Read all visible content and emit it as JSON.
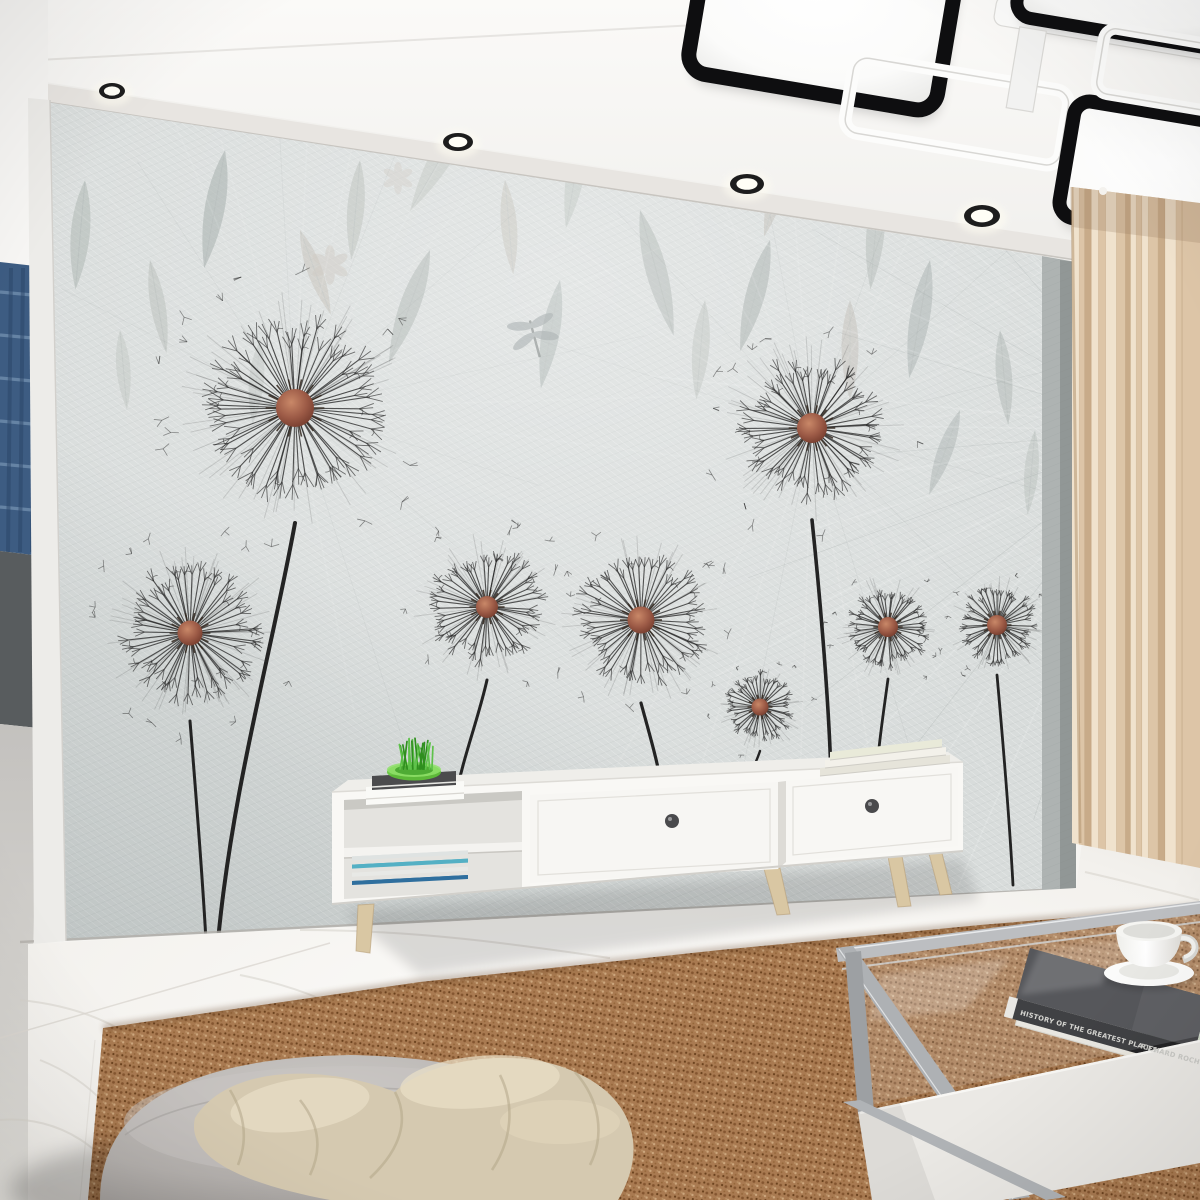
{
  "meta": {
    "description": "Living room interior photo: dandelion mural wallpaper, modern black and white ceiling lamp, white TV console, beige curtain, marble floor, brown sisal rug, gray pouf with beige blanket, glass coffee table with book and teacup",
    "width": 1200,
    "height": 1200
  },
  "palette": {
    "ceiling": "#f7f6f3",
    "molding": "#e8e5e1",
    "wall_base": "#d8dcdb",
    "wall_shade": "#c2c7c7",
    "side_wall": "#aeb3b2",
    "stem": "#232323",
    "spoke": "#2a2a2a",
    "dandelion_center": "#a65c48",
    "dandelion_center_dark": "#6f3a2c",
    "leaf_gray": "#a7aeab",
    "leaf_warm": "#b5ada3",
    "leaf_cool": "#9aa8a9",
    "curtain_light": "#f0e2cd",
    "curtain_mid": "#ddc5a7",
    "curtain_dark": "#c8ab89",
    "marble": "#f8f6f3",
    "marble_vein": "#d5d1ca",
    "rug_base": "#b28257",
    "rug_dark": "#7d5130",
    "rug_light": "#dbb68c",
    "furniture_white": "#f9f8f5",
    "wood_leg": "#d9c7a3",
    "pouf": "#bab6b3",
    "blanket": "#d5c9b0",
    "blanket_fold": "#b3a689",
    "metal": "#b5b7ba",
    "book_cover": "#3d3d40",
    "book_spine": "#232325",
    "spine_text_color": "#d6d6d2",
    "plant_green": "#4db32a",
    "bowl_green": "#5fc437",
    "blue_curtain": "#3d5c82"
  },
  "ceiling": {
    "spotlights": [
      {
        "x": 112,
        "y": 91,
        "rx": 13,
        "ry": 8
      },
      {
        "x": 458,
        "y": 142,
        "rx": 15,
        "ry": 9
      },
      {
        "x": 747,
        "y": 184,
        "rx": 17,
        "ry": 10
      },
      {
        "x": 982,
        "y": 216,
        "rx": 18,
        "ry": 11
      }
    ],
    "molding_top": [
      [
        40,
        82
      ],
      [
        1076,
        240
      ]
    ],
    "molding_bottom": [
      [
        46,
        102
      ],
      [
        1076,
        260
      ]
    ],
    "tray_line": [
      [
        0,
        62
      ],
      [
        715,
        24
      ]
    ]
  },
  "chandelier": {
    "pivot": [
      950,
      80
    ],
    "angle": 9.5,
    "elements": [
      {
        "type": "lit-panel",
        "x": 688,
        "y": -50,
        "w": 252,
        "h": 165,
        "rx": 20,
        "stroke": 15
      },
      {
        "type": "white-frame",
        "x": 853,
        "y": 72,
        "w": 218,
        "h": 76,
        "rx": 14,
        "stroke": 13
      },
      {
        "type": "white-bar",
        "x": 983,
        "y": -12,
        "w": 235,
        "h": 30,
        "rx": 9
      },
      {
        "type": "lit-panel",
        "x": 1003,
        "y": -102,
        "w": 232,
        "h": 108,
        "rx": 16,
        "stroke": 13
      },
      {
        "type": "connector",
        "x": 1010,
        "y": 16,
        "w": 27,
        "h": 82
      },
      {
        "type": "lit-panel",
        "x": 1078,
        "y": 78,
        "w": 225,
        "h": 118,
        "rx": 16,
        "stroke": 14
      },
      {
        "type": "white-frame",
        "x": 1095,
        "y": 2,
        "w": 235,
        "h": 66,
        "rx": 12,
        "stroke": 12
      }
    ]
  },
  "wallpaper": {
    "dandelions": [
      {
        "cx": 295,
        "cy": 408,
        "r": 115,
        "cr": 19,
        "sw": 4.0,
        "stem": "M295,523 C272,650 232,790 218,941"
      },
      {
        "cx": 190,
        "cy": 633,
        "r": 88,
        "cr": 12.5,
        "sw": 3.0,
        "stem": "M190,721 C196,795 202,868 206,941"
      },
      {
        "cx": 487,
        "cy": 607,
        "r": 73,
        "cr": 11,
        "sw": 3.0,
        "stem": "M487,680 C478,720 463,757 455,800"
      },
      {
        "cx": 641,
        "cy": 620,
        "r": 83,
        "cr": 13.5,
        "sw": 3.2,
        "stem": "M641,703 C650,736 657,760 661,783"
      },
      {
        "cx": 812,
        "cy": 428,
        "r": 92,
        "cr": 15,
        "sw": 3.6,
        "stem": "M812,520 C821,606 829,706 831,776"
      },
      {
        "cx": 760,
        "cy": 707,
        "r": 44,
        "cr": 8.5,
        "sw": 2.4,
        "stem": "M760,751 C756,763 751,772 748,781"
      },
      {
        "cx": 888,
        "cy": 627,
        "r": 52,
        "cr": 10,
        "sw": 2.8,
        "stem": "M888,679 C884,709 879,741 877,769"
      },
      {
        "cx": 997,
        "cy": 625,
        "r": 50,
        "cr": 10,
        "sw": 2.8,
        "stem": "M997,675 C1003,742 1009,812 1013,885"
      }
    ],
    "bursts": [
      {
        "cx": 295,
        "cy": 408,
        "n": 26,
        "len": 420,
        "a0": -150,
        "a1": 80,
        "op": 0.09
      },
      {
        "cx": 812,
        "cy": 428,
        "n": 30,
        "len": 470,
        "a0": -160,
        "a1": 120,
        "op": 0.1
      },
      {
        "cx": 1160,
        "cy": 430,
        "n": 26,
        "len": 540,
        "a0": 110,
        "a1": 250,
        "op": 0.14
      }
    ],
    "leaves": [
      {
        "x": 85,
        "y": 180,
        "rot": 95,
        "l": 110,
        "w": 38,
        "c": "#a9b2ae",
        "o": 0.55
      },
      {
        "x": 150,
        "y": 260,
        "rot": 80,
        "l": 95,
        "w": 30,
        "c": "#b2b8b2",
        "o": 0.5
      },
      {
        "x": 225,
        "y": 150,
        "rot": 100,
        "l": 120,
        "w": 40,
        "c": "#9fa8a6",
        "o": 0.6
      },
      {
        "x": 300,
        "y": 230,
        "rot": 70,
        "l": 90,
        "w": 30,
        "c": "#b7b0a6",
        "o": 0.45
      },
      {
        "x": 360,
        "y": 160,
        "rot": 95,
        "l": 100,
        "w": 34,
        "c": "#adb3ae",
        "o": 0.5
      },
      {
        "x": 430,
        "y": 250,
        "rot": 110,
        "l": 120,
        "w": 40,
        "c": "#a3aba8",
        "o": 0.55
      },
      {
        "x": 505,
        "y": 180,
        "rot": 85,
        "l": 95,
        "w": 32,
        "c": "#b5aea4",
        "o": 0.4
      },
      {
        "x": 560,
        "y": 280,
        "rot": 100,
        "l": 110,
        "w": 36,
        "c": "#9aa5a2",
        "o": 0.5
      },
      {
        "x": 640,
        "y": 210,
        "rot": 75,
        "l": 130,
        "w": 42,
        "c": "#a7afab",
        "o": 0.6
      },
      {
        "x": 705,
        "y": 300,
        "rot": 95,
        "l": 100,
        "w": 34,
        "c": "#b0b6b0",
        "o": 0.45
      },
      {
        "x": 770,
        "y": 240,
        "rot": 105,
        "l": 115,
        "w": 38,
        "c": "#9ba4a1",
        "o": 0.55
      },
      {
        "x": 850,
        "y": 300,
        "rot": 90,
        "l": 100,
        "w": 34,
        "c": "#b3aca2",
        "o": 0.4
      },
      {
        "x": 930,
        "y": 260,
        "rot": 100,
        "l": 120,
        "w": 40,
        "c": "#a2abaa",
        "o": 0.55
      },
      {
        "x": 1000,
        "y": 330,
        "rot": 85,
        "l": 95,
        "w": 32,
        "c": "#aab2af",
        "o": 0.5
      },
      {
        "x": 960,
        "y": 410,
        "rot": 110,
        "l": 90,
        "w": 30,
        "c": "#9fa9a7",
        "o": 0.45
      },
      {
        "x": 1035,
        "y": 430,
        "rot": 95,
        "l": 85,
        "w": 28,
        "c": "#b0b7b3",
        "o": 0.4
      },
      {
        "x": 120,
        "y": 330,
        "rot": 85,
        "l": 80,
        "w": 28,
        "c": "#b6bcb6",
        "o": 0.4
      },
      {
        "x": 260,
        "y": 340,
        "rot": 95,
        "l": 85,
        "w": 30,
        "c": "#aab1ad",
        "o": 0.35
      },
      {
        "x": 480,
        "y": 90,
        "rot": 120,
        "l": 140,
        "w": 46,
        "c": "#b4bab4",
        "o": 0.5
      },
      {
        "x": 585,
        "y": 120,
        "rot": 100,
        "l": 110,
        "w": 36,
        "c": "#adb5b0",
        "o": 0.45
      },
      {
        "x": 680,
        "y": 80,
        "rot": 90,
        "l": 120,
        "w": 40,
        "c": "#a5aeab",
        "o": 0.5
      },
      {
        "x": 790,
        "y": 140,
        "rot": 105,
        "l": 100,
        "w": 34,
        "c": "#b0a99f",
        "o": 0.4
      },
      {
        "x": 880,
        "y": 180,
        "rot": 95,
        "l": 110,
        "w": 36,
        "c": "#a8b0ac",
        "o": 0.5
      },
      {
        "x": 1080,
        "y": 350,
        "rot": 100,
        "l": 80,
        "w": 26,
        "c": "#9fa8a5",
        "o": 0.45
      },
      {
        "x": 420,
        "y": 60,
        "rot": 80,
        "l": 100,
        "w": 32,
        "c": "#b9bfb9",
        "o": 0.4
      }
    ],
    "flowers": [
      {
        "x": 330,
        "y": 265,
        "r": 16,
        "c": "#c6c0b8",
        "o": 0.5
      },
      {
        "x": 398,
        "y": 178,
        "r": 13,
        "c": "#c9c4bc",
        "o": 0.45
      }
    ],
    "dragonfly": {
      "x": 533,
      "y": 332,
      "rot": -15,
      "c": "#8d9697",
      "o": 0.6
    }
  },
  "left_room": {
    "stripe_count": 6,
    "fold_count": 3
  },
  "curtain": {
    "x0": 1072,
    "x1": 1200,
    "top0": 187,
    "top1": 203,
    "bot0": 843,
    "bot1": 868,
    "pleats": 15
  },
  "tv_stand": {
    "knobs": [
      [
        672,
        821
      ],
      [
        872,
        806
      ]
    ],
    "shelf_magazines": [
      "#2f6f9e",
      "#e8e9e6",
      "#54b0c4",
      "#dfe3e2"
    ],
    "top_magazines": [
      "#e6e4da",
      "#f3f1ea",
      "#e9ead9"
    ]
  },
  "coffee_table": {
    "book": {
      "title": "HISTORY OF THE GREATEST PLACES",
      "author": "RICHARD ROCH"
    }
  }
}
